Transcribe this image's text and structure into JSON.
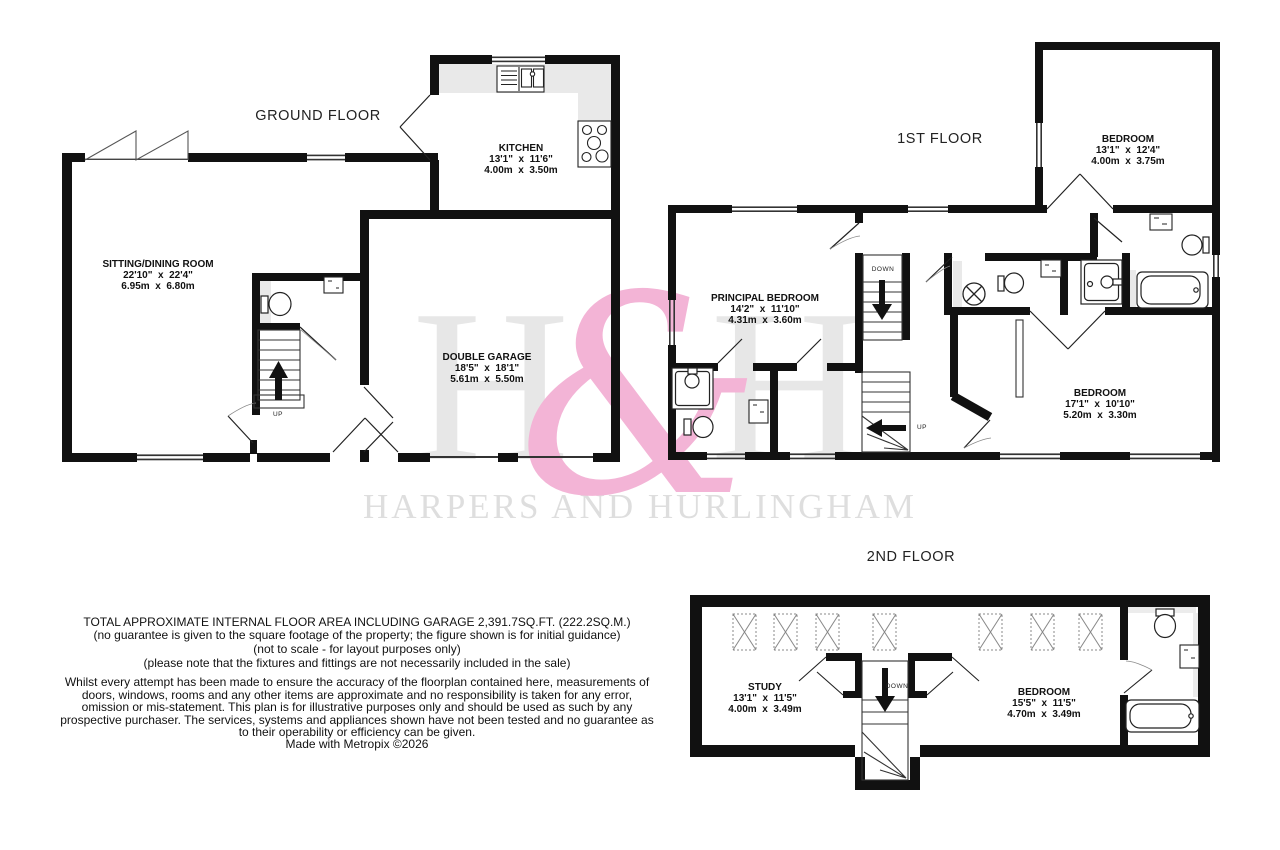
{
  "watermark": {
    "monogram_left": "H",
    "ampersand": "&",
    "monogram_right": "H",
    "wordmark": "HARPERS AND HURLINGHAM",
    "gray": "#e7e7e7",
    "pink": "#f3b4d6"
  },
  "floors": [
    {
      "title": "GROUND FLOOR",
      "stair_up": "UP",
      "rooms": [
        {
          "name": "SITTING/DINING ROOM",
          "imperial": "22'10\"  x  22'4\"",
          "metric": "6.95m  x  6.80m"
        },
        {
          "name": "KITCHEN",
          "imperial": "13'1\"  x  11'6\"",
          "metric": "4.00m  x  3.50m"
        },
        {
          "name": "DOUBLE GARAGE",
          "imperial": "18'5\"  x  18'1\"",
          "metric": "5.61m  x  5.50m"
        }
      ]
    },
    {
      "title": "1ST FLOOR",
      "stair_down": "DOWN",
      "stair_up": "UP",
      "rooms": [
        {
          "name": "BEDROOM",
          "imperial": "13'1\"  x  12'4\"",
          "metric": "4.00m  x  3.75m"
        },
        {
          "name": "PRINCIPAL BEDROOM",
          "imperial": "14'2\"  x  11'10\"",
          "metric": "4.31m  x  3.60m"
        },
        {
          "name": "BEDROOM",
          "imperial": "17'1\"  x  10'10\"",
          "metric": "5.20m  x  3.30m"
        }
      ]
    },
    {
      "title": "2ND FLOOR",
      "stair_down": "DOWN",
      "rooms": [
        {
          "name": "STUDY",
          "imperial": "13'1\"  x  11'5\"",
          "metric": "4.00m  x  3.49m"
        },
        {
          "name": "BEDROOM",
          "imperial": "15'5\"  x  11'5\"",
          "metric": "4.70m  x  3.49m"
        }
      ]
    }
  ],
  "disclaimer": {
    "area_line": "TOTAL APPROXIMATE INTERNAL FLOOR AREA INCLUDING GARAGE 2,391.7SQ.FT. (222.2SQ.M.)",
    "notes": [
      "(no guarantee is given to the square footage of the property; the figure shown is for initial guidance)",
      "(not to scale - for layout purposes only)",
      "(please note that the fixtures and fittings are not necessarily included in the sale)"
    ],
    "body": "Whilst every attempt has been made to ensure the accuracy of the floorplan contained here, measurements of doors, windows, rooms and any other items are approximate and no responsibility is taken for any error, omission or mis-statement. This plan is for illustrative purposes only and should be used as such by any prospective purchaser. The services, systems and appliances shown have not been tested and no guarantee as to their operability or efficiency can be given.",
    "credit": "Made with Metropix ©2026"
  }
}
